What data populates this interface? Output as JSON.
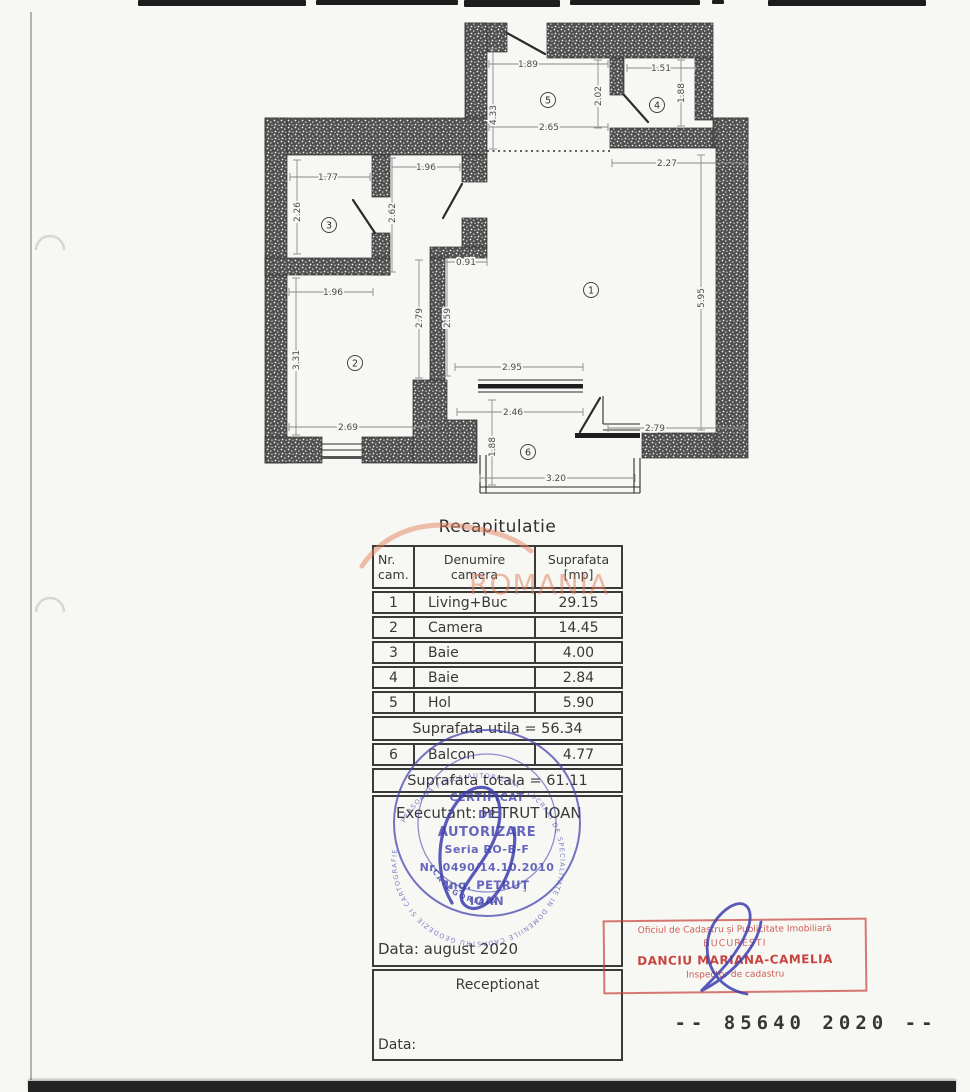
{
  "page": {
    "watermark": "ROMANIA"
  },
  "recap": {
    "title": "Recapitulatie",
    "header": {
      "col1a": "Nr.",
      "col1b": "cam.",
      "col2a": "Denumire",
      "col2b": "camera",
      "col3a": "Suprafata",
      "col3b": "[mp]"
    },
    "rows": [
      {
        "nr": "1",
        "name": "Living+Buc",
        "area": "29.15"
      },
      {
        "nr": "2",
        "name": "Camera",
        "area": "14.45"
      },
      {
        "nr": "3",
        "name": "Baie",
        "area": "4.00"
      },
      {
        "nr": "4",
        "name": "Baie",
        "area": "2.84"
      },
      {
        "nr": "5",
        "name": "Hol",
        "area": "5.90"
      }
    ],
    "utila": "Suprafata utila = 56.34",
    "balcon": {
      "nr": "6",
      "name": "Balcon",
      "area": "4.77"
    },
    "totala": "Suprafata totala = 61.11",
    "executant": "Executant: PETRUT IOAN",
    "executant_date": "Data: august 2020",
    "receptionat": "Receptionat",
    "reception_date": "Data:"
  },
  "floor_plan": {
    "dimensions": [
      {
        "t": "1.89",
        "x": 528,
        "y": 64,
        "v": 0,
        "l": [
          489,
          64,
          608,
          64
        ]
      },
      {
        "t": "1.51",
        "x": 661,
        "y": 68,
        "v": 0,
        "l": [
          627,
          68,
          695,
          68
        ]
      },
      {
        "t": "2.02",
        "x": 598,
        "y": 96,
        "v": 1,
        "l": [
          598,
          60,
          598,
          128
        ]
      },
      {
        "t": "1.88",
        "x": 681,
        "y": 93,
        "v": 1,
        "l": [
          681,
          60,
          681,
          126
        ]
      },
      {
        "t": "2.65",
        "x": 549,
        "y": 127,
        "v": 0,
        "l": [
          489,
          127,
          608,
          127
        ]
      },
      {
        "t": "4.33",
        "x": 493,
        "y": 115,
        "v": 1,
        "l": [
          493,
          49,
          493,
          149
        ]
      },
      {
        "t": "2.27",
        "x": 667,
        "y": 163,
        "v": 0,
        "l": [
          612,
          163,
          745,
          163
        ]
      },
      {
        "t": "1.77",
        "x": 328,
        "y": 177,
        "v": 0,
        "l": [
          290,
          177,
          370,
          177
        ]
      },
      {
        "t": "1.96",
        "x": 426,
        "y": 167,
        "v": 0,
        "l": [
          392,
          167,
          460,
          167
        ]
      },
      {
        "t": "2.26",
        "x": 297,
        "y": 212,
        "v": 1,
        "l": [
          297,
          160,
          297,
          254
        ]
      },
      {
        "t": "2.62",
        "x": 392,
        "y": 213,
        "v": 1,
        "l": [
          392,
          158,
          392,
          272
        ]
      },
      {
        "t": "0.91",
        "x": 466,
        "y": 262,
        "v": 0,
        "l": [
          447,
          262,
          487,
          262
        ]
      },
      {
        "t": "1.96",
        "x": 333,
        "y": 292,
        "v": 0,
        "l": [
          289,
          292,
          373,
          292
        ]
      },
      {
        "t": "2.79",
        "x": 419,
        "y": 318,
        "v": 1,
        "l": [
          419,
          260,
          419,
          378
        ]
      },
      {
        "t": "2.59",
        "x": 447,
        "y": 318,
        "v": 1,
        "l": [
          447,
          262,
          447,
          376
        ]
      },
      {
        "t": "3.31",
        "x": 296,
        "y": 360,
        "v": 1,
        "l": [
          296,
          278,
          296,
          435
        ]
      },
      {
        "t": "5.95",
        "x": 701,
        "y": 298,
        "v": 1,
        "l": [
          701,
          155,
          701,
          430
        ]
      },
      {
        "t": "2.95",
        "x": 512,
        "y": 367,
        "v": 0,
        "l": [
          455,
          367,
          583,
          367
        ]
      },
      {
        "t": "2.46",
        "x": 513,
        "y": 412,
        "v": 0,
        "l": [
          457,
          412,
          583,
          412
        ]
      },
      {
        "t": "2.69",
        "x": 348,
        "y": 427,
        "v": 0,
        "l": [
          289,
          427,
          428,
          427
        ]
      },
      {
        "t": "2.79",
        "x": 655,
        "y": 428,
        "v": 0,
        "l": [
          608,
          428,
          743,
          428
        ]
      },
      {
        "t": "1.88",
        "x": 492,
        "y": 447,
        "v": 1,
        "l": [
          492,
          400,
          492,
          485
        ]
      },
      {
        "t": "3.20",
        "x": 556,
        "y": 478,
        "v": 0,
        "l": [
          480,
          478,
          635,
          478
        ]
      }
    ],
    "rooms": [
      {
        "n": "1",
        "x": 591,
        "y": 290
      },
      {
        "n": "2",
        "x": 355,
        "y": 363
      },
      {
        "n": "3",
        "x": 329,
        "y": 225
      },
      {
        "n": "4",
        "x": 657,
        "y": 105
      },
      {
        "n": "5",
        "x": 548,
        "y": 100
      },
      {
        "n": "6",
        "x": 528,
        "y": 452
      }
    ]
  },
  "stamps": {
    "blue": {
      "color": "#4646b0",
      "lines": [
        "CERTIFICAT",
        "DE",
        "AUTORIZARE",
        "Seria RO-B-F",
        "Nr. 0490/14.10.2010",
        "Ing. PETRUŢ",
        "IOAN"
      ],
      "ring_text": "PERSOANA FIZICA AUTORIZATA · LUCRARI DE SPECIALITATE IN DOMENIILE CADASTRU GEODEZIE SI CARTOGRAFIE ·",
      "arc_text": "CATEGORIA A"
    },
    "red": {
      "color": "#c23b32",
      "line1": "Oficiul de Cadastru și Publicitate Imobiliară",
      "line2": "BUCUREȘTI",
      "line3": "DANCIU MARIANA-CAMELIA",
      "line4": "Inspector de cadastru"
    },
    "registration_number": "-- 85640 2020 --"
  }
}
